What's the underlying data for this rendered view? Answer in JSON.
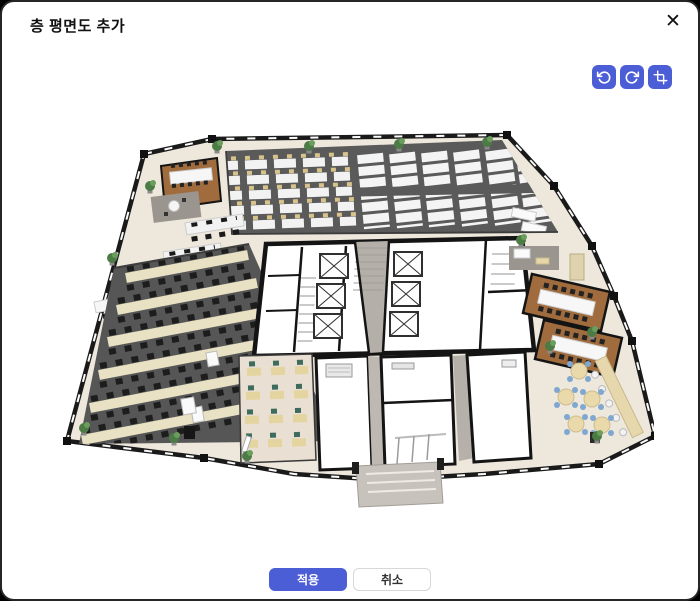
{
  "dialog": {
    "title": "층 평면도 추가",
    "close_icon": "✕"
  },
  "toolbar": {
    "accent_color": "#4c5ed6",
    "buttons": [
      {
        "id": "rotate-left",
        "icon": "rotate-ccw-icon"
      },
      {
        "id": "rotate-right",
        "icon": "rotate-cw-icon"
      },
      {
        "id": "crop",
        "icon": "crop-icon"
      }
    ]
  },
  "floor_plan": {
    "label": "3D 오피스 층 평면도 이미지",
    "colors": {
      "carpet_dark": "#5a5a5a",
      "floor_beige": "#ede7dc",
      "wall_black": "#1a1a1a",
      "wood_brown": "#a06c3e",
      "desk_beige": "#e9e1c3",
      "desk_white": "#f4f4f4",
      "chair_black": "#1d1d1d",
      "chair_teal": "#3d6b5c",
      "chair_blue": "#7fa7cf",
      "corridor_gray": "#b4b0a9",
      "plant_green": "#4c7b45"
    }
  },
  "footer": {
    "apply_label": "적용",
    "cancel_label": "취소"
  }
}
